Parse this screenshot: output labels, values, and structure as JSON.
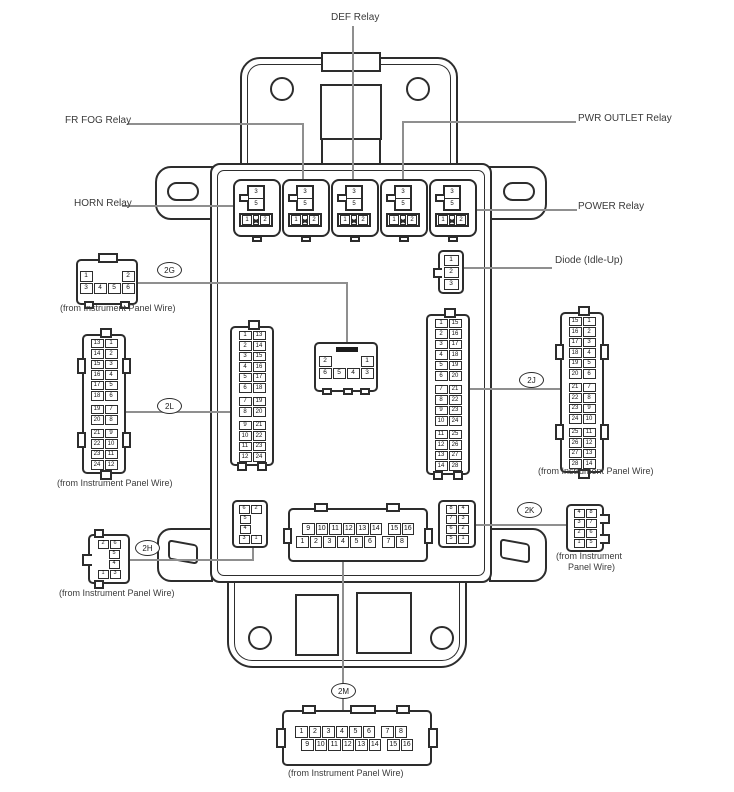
{
  "labels": {
    "def_relay": "DEF Relay",
    "fr_fog_relay": "FR FOG Relay",
    "pwr_outlet_relay": "PWR OUTLET Relay",
    "horn_relay": "HORN Relay",
    "power_relay": "POWER Relay",
    "diode": "Diode (Idle-Up)",
    "from_ipw": "(from Instrument Panel Wire)",
    "from_ipw_l1": "(from Instrument",
    "from_ipw_l2": "Panel Wire)"
  },
  "ovals": {
    "g2": "2G",
    "l2": "2L",
    "j2": "2J",
    "h2": "2H",
    "k2": "2K",
    "m2": "2M"
  },
  "relay_pins": {
    "top": "3",
    "mid": "5",
    "left": "1",
    "right": "2"
  },
  "connectors": {
    "g2_out": [
      [
        [
          "1",
          "|",
          "|",
          "2"
        ],
        [
          "3",
          "4",
          "5",
          "6"
        ]
      ]
    ],
    "g2_in": [
      [
        [
          "2",
          "|",
          "|",
          "1"
        ],
        [
          "6",
          "5",
          "4",
          "3"
        ]
      ]
    ],
    "l2_out": [
      [
        [
          "13",
          "1"
        ],
        [
          "14",
          "2"
        ],
        [
          "15",
          "3"
        ],
        [
          "16",
          "4"
        ],
        [
          "17",
          "5"
        ],
        [
          "18",
          "6"
        ]
      ],
      [
        [
          "19",
          "7"
        ],
        [
          "20",
          "8"
        ]
      ],
      [
        [
          "21",
          "9"
        ],
        [
          "22",
          "10"
        ],
        [
          "23",
          "11"
        ],
        [
          "24",
          "12"
        ]
      ]
    ],
    "l2_in": [
      [
        [
          "1",
          "13"
        ],
        [
          "2",
          "14"
        ],
        [
          "3",
          "15"
        ],
        [
          "4",
          "16"
        ],
        [
          "5",
          "17"
        ],
        [
          "6",
          "18"
        ]
      ],
      [
        [
          "7",
          "19"
        ],
        [
          "8",
          "20"
        ]
      ],
      [
        [
          "9",
          "21"
        ],
        [
          "10",
          "22"
        ],
        [
          "11",
          "23"
        ],
        [
          "12",
          "24"
        ]
      ]
    ],
    "j2_in": [
      [
        [
          "1",
          "15"
        ],
        [
          "2",
          "16"
        ],
        [
          "3",
          "17"
        ],
        [
          "4",
          "18"
        ],
        [
          "5",
          "19"
        ],
        [
          "6",
          "20"
        ]
      ],
      [
        [
          "7",
          "21"
        ],
        [
          "8",
          "22"
        ],
        [
          "9",
          "23"
        ],
        [
          "10",
          "24"
        ]
      ],
      [
        [
          "11",
          "25"
        ],
        [
          "12",
          "26"
        ],
        [
          "13",
          "27"
        ],
        [
          "14",
          "28"
        ]
      ]
    ],
    "j2_out": [
      [
        [
          "15",
          "1"
        ],
        [
          "16",
          "2"
        ],
        [
          "17",
          "3"
        ],
        [
          "18",
          "4"
        ],
        [
          "19",
          "5"
        ],
        [
          "20",
          "6"
        ]
      ],
      [
        [
          "21",
          "7"
        ],
        [
          "22",
          "8"
        ],
        [
          "23",
          "9"
        ],
        [
          "24",
          "10"
        ]
      ],
      [
        [
          "25",
          "11"
        ],
        [
          "26",
          "12"
        ],
        [
          "27",
          "13"
        ],
        [
          "28",
          "14"
        ]
      ]
    ],
    "h2_out": [
      [
        [
          "2",
          "6"
        ],
        [
          "",
          "5"
        ],
        [
          "",
          "4"
        ],
        [
          "1",
          "3"
        ]
      ]
    ],
    "h2_in": [
      [
        [
          "6",
          "2"
        ],
        [
          "5",
          ""
        ],
        [
          "4",
          ""
        ],
        [
          "3",
          "1"
        ]
      ]
    ],
    "k2_in": [
      [
        [
          "8",
          "4"
        ],
        [
          "7",
          "3"
        ],
        [
          "6",
          "2"
        ],
        [
          "5",
          "1"
        ]
      ]
    ],
    "k2_out": [
      [
        [
          "4",
          "8"
        ],
        [
          "3",
          "7"
        ],
        [
          "2",
          "6"
        ],
        [
          "1",
          "5"
        ]
      ]
    ],
    "m2_in": [
      [
        [
          "9",
          "10",
          "11",
          "12",
          "13",
          "14",
          ".",
          "15",
          "16"
        ],
        [
          "1",
          "2",
          "3",
          "4",
          "5",
          "6",
          ".",
          "7",
          "8",
          ""
        ]
      ]
    ],
    "m2_out": [
      [
        [
          "1",
          "2",
          "3",
          "4",
          "5",
          "6",
          ".",
          "7",
          "8",
          ""
        ],
        [
          "9",
          "10",
          "11",
          "12",
          "13",
          "14",
          ".",
          "15",
          "16"
        ]
      ]
    ],
    "diode": [
      [
        [
          "1"
        ],
        [
          "2"
        ],
        [
          "3"
        ]
      ]
    ]
  }
}
